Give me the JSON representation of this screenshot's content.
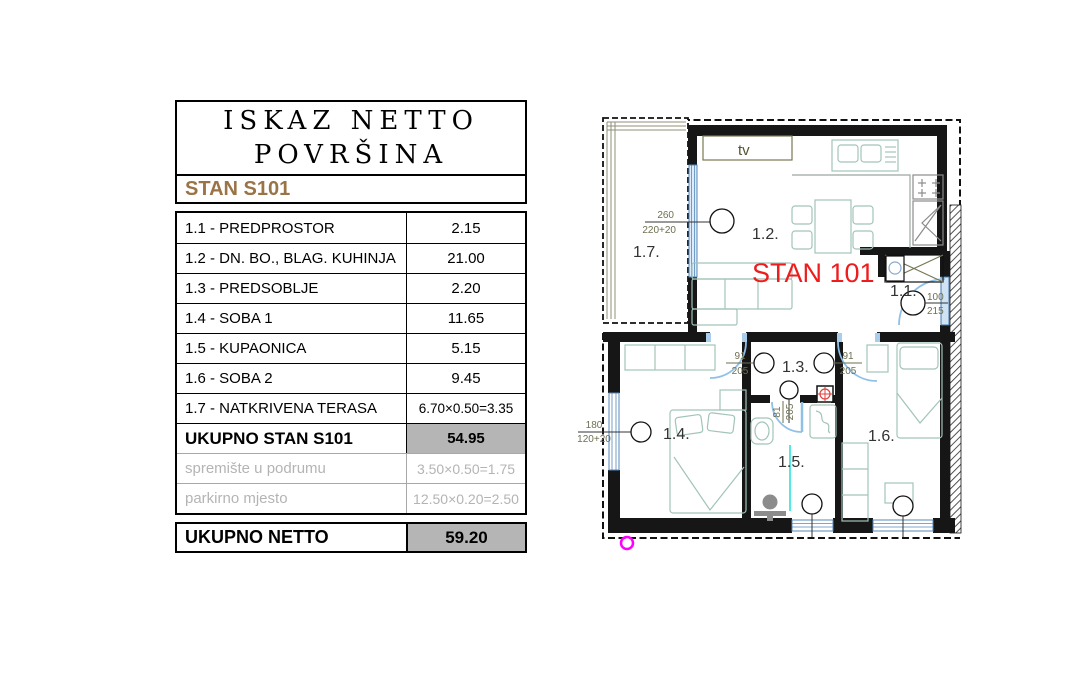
{
  "table": {
    "title_line1": "ISKAZ NETTO",
    "title_line2": "POVRŠINA",
    "subtitle": "STAN S101",
    "rows": [
      {
        "label": "1.1 - PREDPROSTOR",
        "value": "2.15"
      },
      {
        "label": "1.2 - DN. BO., BLAG. KUHINJA",
        "value": "21.00"
      },
      {
        "label": "1.3 - PREDSOBLJE",
        "value": "2.20"
      },
      {
        "label": "1.4 - SOBA 1",
        "value": "11.65"
      },
      {
        "label": "1.5 - KUPAONICA",
        "value": "5.15"
      },
      {
        "label": "1.6 - SOBA 2",
        "value": "9.45"
      },
      {
        "label": "1.7 - NATKRIVENA TERASA",
        "value": "6.70×0.50=3.35"
      }
    ],
    "total_row": {
      "label": "UKUPNO STAN S101",
      "value": "54.95"
    },
    "muted_rows": [
      {
        "label": "spremište u podrumu",
        "value": "3.50×0.50=1.75"
      },
      {
        "label": "parkirno mjesto",
        "value": "12.50×0.20=2.50"
      }
    ],
    "net_row": {
      "label": "UKUPNO NETTO",
      "value": "59.20"
    }
  },
  "floorplan": {
    "apartment_label": "STAN 101",
    "tv_label": "tv",
    "rooms": {
      "r11": "1.1.",
      "r12": "1.2.",
      "r13": "1.3.",
      "r14": "1.4.",
      "r15": "1.5.",
      "r16": "1.6.",
      "r17": "1.7."
    },
    "dims": {
      "terrace_door": {
        "top": "260",
        "bottom": "220+20"
      },
      "entry_door": {
        "top": "100",
        "bottom": "215"
      },
      "hall_left": {
        "top": "91",
        "bottom": "205"
      },
      "hall_right": {
        "top": "91",
        "bottom": "205"
      },
      "bath_door": {
        "top": "81",
        "bottom": "205"
      },
      "bedroom_window": {
        "top": "180",
        "bottom": "120+20"
      }
    },
    "colors": {
      "wall": "#161616",
      "furniture": "#a2c4b8",
      "door_arc": "#8fc1e8",
      "dimension_text": "#6f6f52",
      "apartment_red": "#ee1c1c",
      "marker_magenta": "#ff00ff",
      "accent_brown": "#9a7446"
    }
  }
}
